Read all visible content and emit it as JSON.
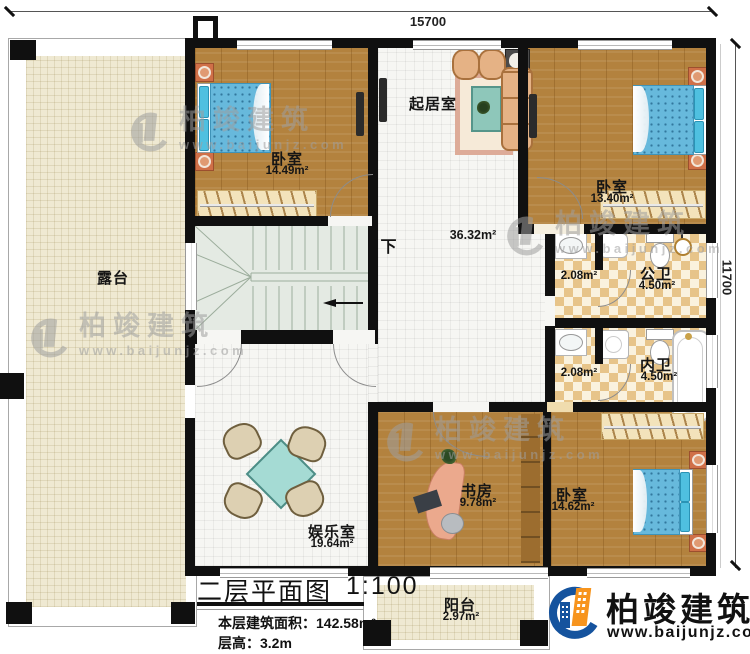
{
  "dims": {
    "width": "15700",
    "height": "11700"
  },
  "rooms": {
    "bedroom1": {
      "name": "卧室",
      "area": "14.49m²"
    },
    "living": {
      "name": "起居室"
    },
    "bedroom2": {
      "name": "卧室",
      "area": "13.40m²"
    },
    "terrace": {
      "name": "露台"
    },
    "hall": {
      "area": "36.32m²"
    },
    "wash_pub": {
      "area": "2.08m²"
    },
    "bath_pub": {
      "name": "公卫",
      "area": "4.50m²"
    },
    "wash_priv": {
      "area": "2.08m²"
    },
    "bath_priv": {
      "name": "内卫",
      "area": "4.50m²"
    },
    "study": {
      "name": "书房",
      "area": "9.78m²"
    },
    "bedroom3": {
      "name": "卧室",
      "area": "14.62m²"
    },
    "entertainment": {
      "name": "娱乐室",
      "area": "19.64m²"
    },
    "balcony": {
      "name": "阳台",
      "area": "2.97m²"
    }
  },
  "stairs": {
    "down_label": "下"
  },
  "title_block": {
    "title": "二层平面图",
    "scale": "1:100",
    "area_label": "本层建筑面积：",
    "area_value": "142.58m²",
    "height_label": "层高：",
    "height_value": "3.2m"
  },
  "brand": {
    "name": "柏竣建筑",
    "website": "www.baijunjz.com"
  },
  "colors": {
    "wall": "#101010",
    "wood": "#b3823e",
    "tile": "#f6f6f3",
    "terrace": "#efe9d2",
    "checker": "#e7c489",
    "stairs": "#e4eae3",
    "bed": "#67b9dc",
    "accent_blue": "#15539e",
    "accent_orange": "#f7941d"
  }
}
